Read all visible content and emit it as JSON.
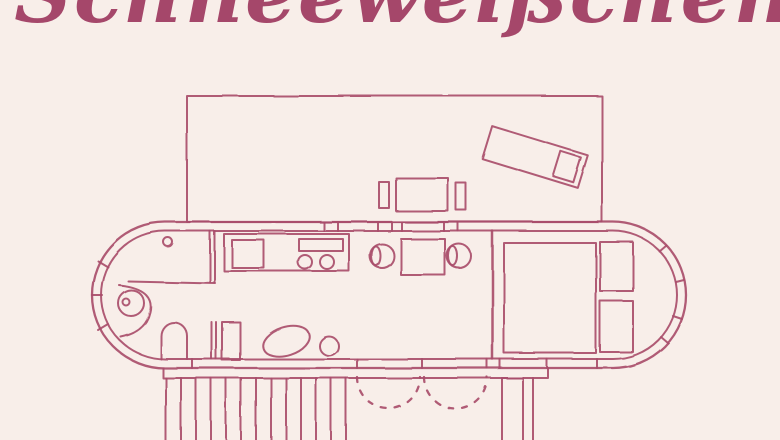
{
  "page": {
    "title": {
      "text": "Schneeweißchen",
      "color": "#a5476a"
    },
    "colors": {
      "background": "#f8eee9",
      "line": "#a94e6b"
    }
  },
  "floor_plan": {
    "subject": "caravan-trailer-floor-plan-top-view",
    "upper_deck": {
      "elements": [
        "deck-rectangle",
        "sun-lounger",
        "lounger-pillow",
        "patio-table",
        "patio-bench-left",
        "patio-bench-right"
      ]
    },
    "cabin": {
      "hull": [
        "outer-wall",
        "inner-wall",
        "window-ticks-left-nose",
        "window-ticks-right-nose",
        "window-ticks-top-wall",
        "window-ticks-bottom-wall"
      ],
      "bathroom": [
        "vanity-counter",
        "vanity-knob",
        "round-basin",
        "basin-counter",
        "toilet",
        "partition-wall-upper",
        "partition-wall-lower",
        "shower-stall"
      ],
      "kitchen": [
        "kitchen-counter",
        "sink",
        "stove-panel",
        "burner-left",
        "burner-right"
      ],
      "dining": [
        "dining-chair-left",
        "dining-table",
        "dining-chair-right"
      ],
      "lounge": [
        "oval-ottoman",
        "round-stool"
      ],
      "bedroom": [
        "bedroom-partition",
        "bed",
        "cabinet-top",
        "cabinet-bottom"
      ]
    },
    "lower_deck": {
      "elements": [
        "deck-edge-band",
        "boardwalk-planks",
        "door-swing-arc-left",
        "door-swing-arc-right",
        "step-platform",
        "step-rail"
      ]
    }
  }
}
